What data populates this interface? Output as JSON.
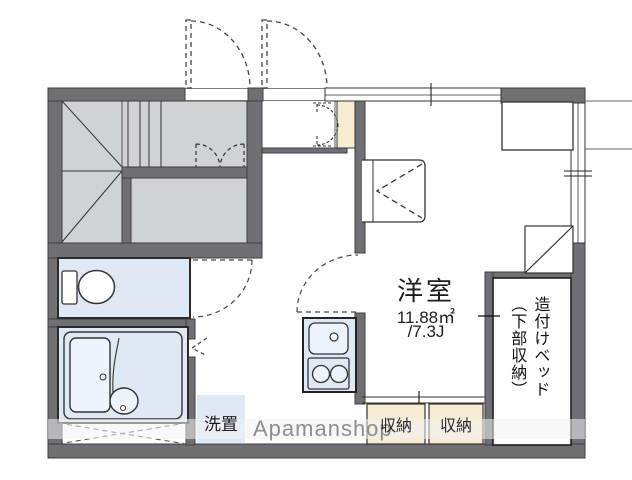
{
  "plan_type": "floor-plan",
  "room": {
    "name": "洋室",
    "area_m2": "11.88㎡",
    "area_jo": "/7.3J"
  },
  "bed": {
    "line1": "造付けベッド",
    "line2": "（下部収納）"
  },
  "storages": [
    "収納",
    "収納"
  ],
  "washer_label": "洗置",
  "watermark": "Apamanshop",
  "colors": {
    "wall": "#6f6f74",
    "stair_area": "#d1d2d4",
    "wet_room": "#dfe9f5",
    "closet": "#f6ecd2",
    "fixture_fill": "#edf4fb",
    "line": "#2b2b2b",
    "watermark_text": "#8e8e8e"
  }
}
